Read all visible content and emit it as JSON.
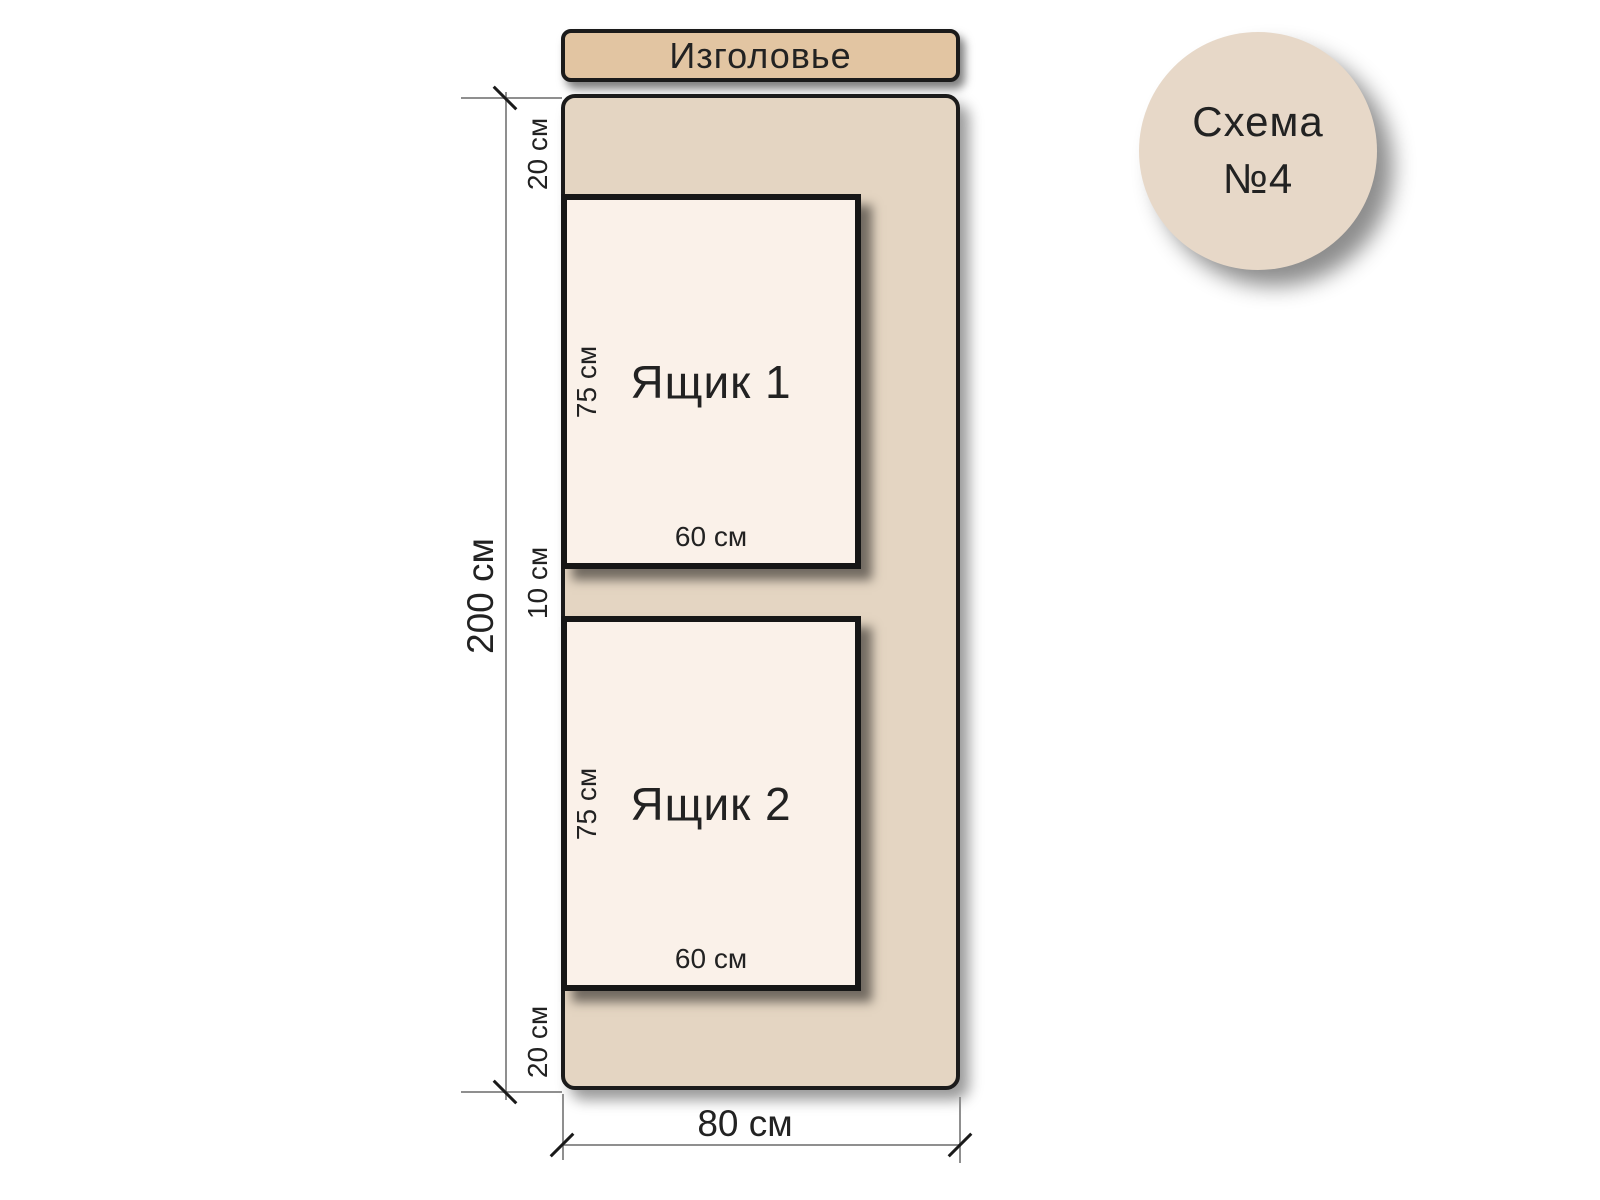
{
  "badge": {
    "line1": "Схема",
    "line2": "№4"
  },
  "headboard_label": "Изголовье",
  "dimensions": {
    "total_height": "200 см",
    "total_width": "80 см",
    "top_margin": "20 см",
    "gap": "10 см",
    "bottom_margin": "20 см"
  },
  "drawers": [
    {
      "name": "Ящик 1",
      "height": "75 см",
      "width": "60 см"
    },
    {
      "name": "Ящик 2",
      "height": "75 см",
      "width": "60 см"
    }
  ],
  "colors": {
    "headboard-fill": "#e2c5a2",
    "bed-fill": "#e4d5c2",
    "drawer-fill": "#faf1e9",
    "badge-fill": "#e7d8c8",
    "outline": "#1b1b1b",
    "dim-line": "#8f8f8f",
    "text": "#222222"
  }
}
